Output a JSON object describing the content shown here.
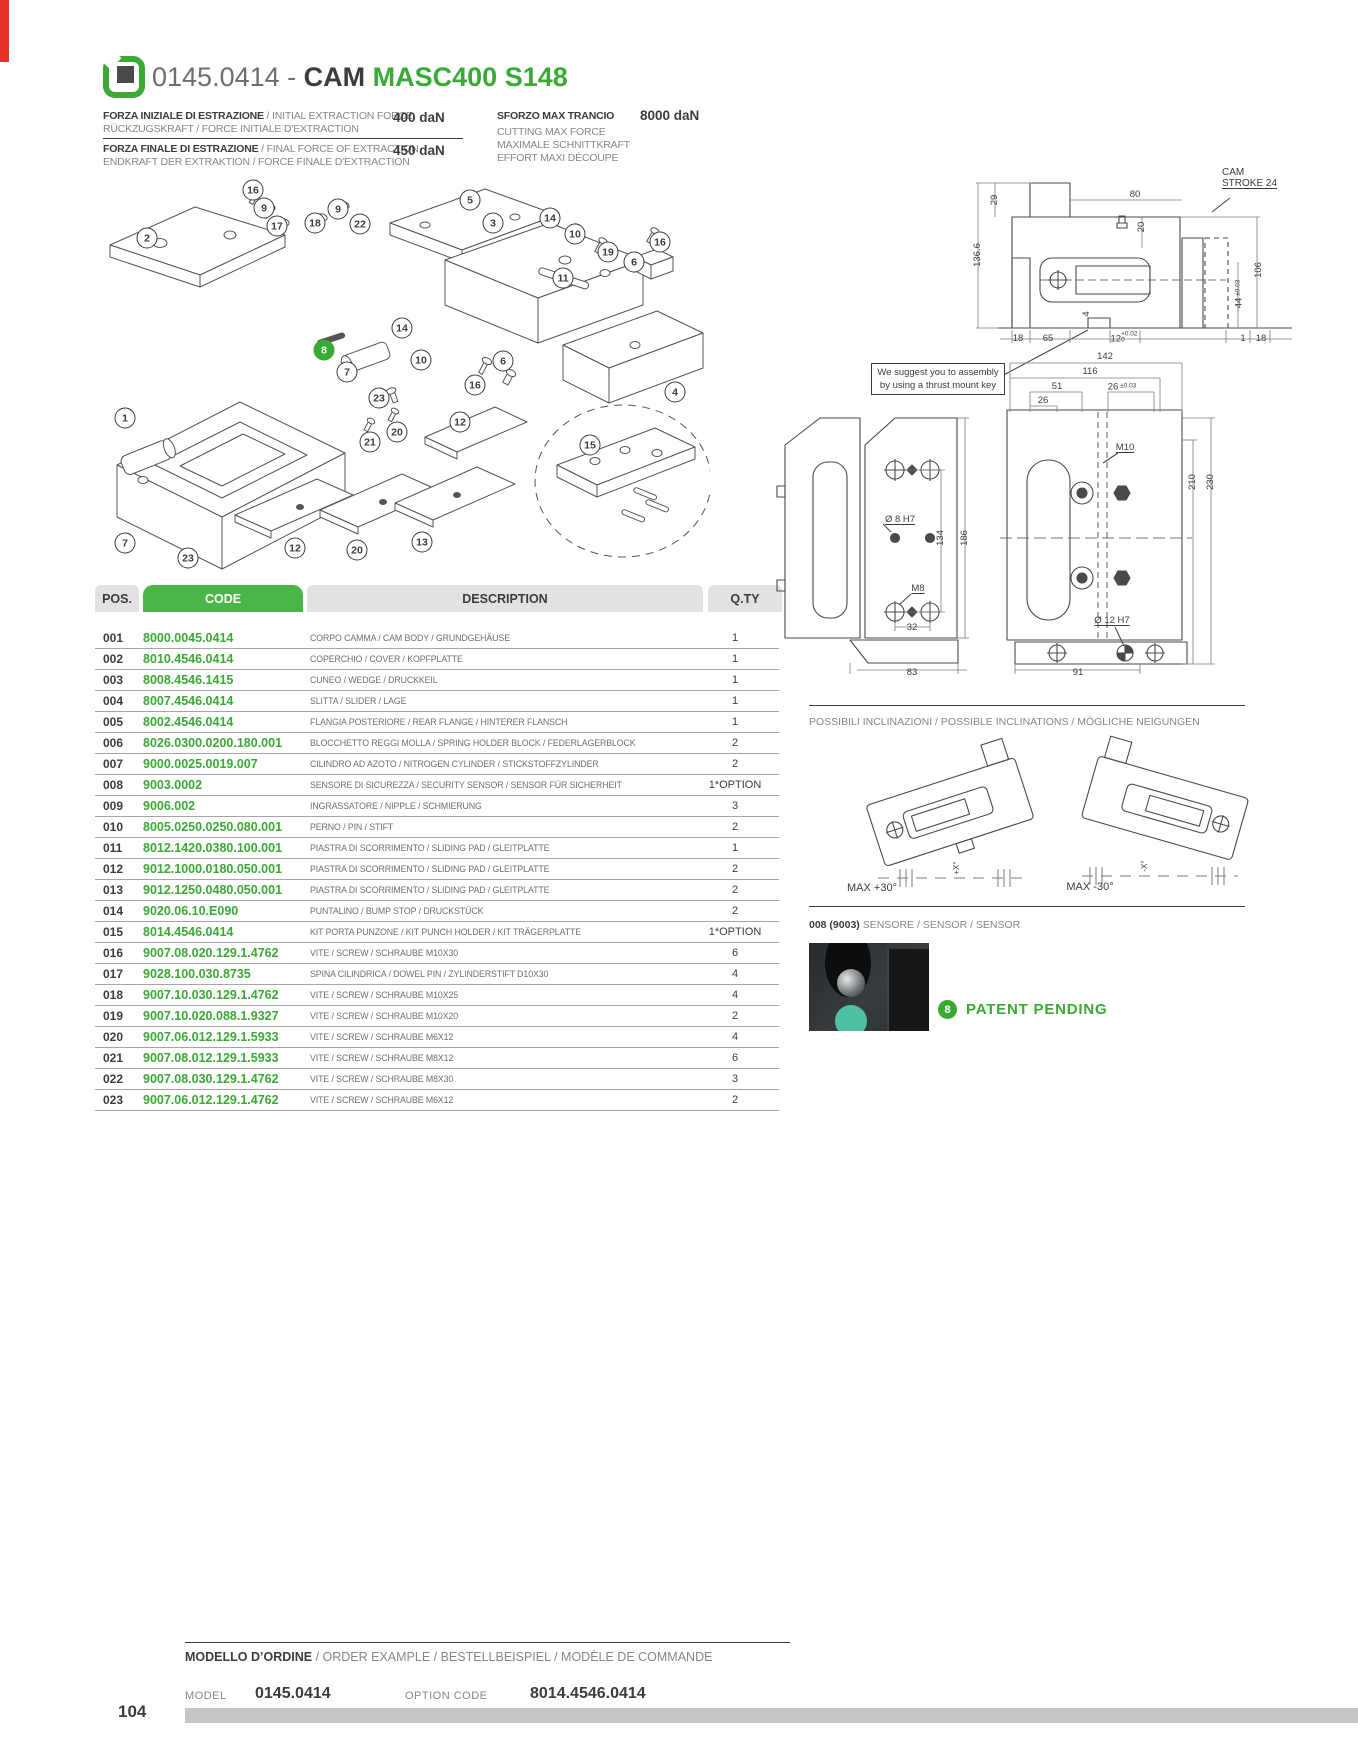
{
  "page": {
    "number": "104"
  },
  "colors": {
    "green": "#3aaa35",
    "green_header": "#4bb648",
    "dark": "#3c3c3b",
    "gray": "#878786",
    "red": "#e5332a"
  },
  "header": {
    "prefix": "0145.0414",
    "separator": " - ",
    "name": "CAM ",
    "variant": "MASC400 S148",
    "logo_icon": "brand-cam-icon"
  },
  "specs": {
    "rows": [
      {
        "primary": "FORZA INIZIALE DI ESTRAZIONE",
        "secondary": " / INITIAL EXTRACTION FORCE",
        "line2": "RÜCKZUGSKRAFT / FORCE INITIALE D'EXTRACTION",
        "value": "400 daN"
      },
      {
        "primary": "FORZA FINALE DI ESTRAZIONE",
        "secondary": " / FINAL FORCE OF EXTRACTION",
        "line2": "ENDKRAFT DER EXTRAKTION / FORCE FINALE D'EXTRACTION",
        "value": "450 daN"
      }
    ],
    "max_cut": {
      "title": "SFORZO MAX TRANCIO",
      "value": "8000 daN",
      "lines": [
        "CUTTING MAX FORCE",
        "MAXIMALE SCHNITTKRAFT",
        "EFFORT MAXI DÉCOUPE"
      ]
    }
  },
  "exploded": {
    "balloons": [
      {
        "n": "16",
        "x": 253,
        "y": 190
      },
      {
        "n": "9",
        "x": 264,
        "y": 208
      },
      {
        "n": "17",
        "x": 277,
        "y": 226
      },
      {
        "n": "2",
        "x": 147,
        "y": 238
      },
      {
        "n": "18",
        "x": 315,
        "y": 223
      },
      {
        "n": "9",
        "x": 338,
        "y": 209
      },
      {
        "n": "22",
        "x": 360,
        "y": 224
      },
      {
        "n": "5",
        "x": 470,
        "y": 200
      },
      {
        "n": "3",
        "x": 493,
        "y": 223
      },
      {
        "n": "14",
        "x": 550,
        "y": 218
      },
      {
        "n": "10",
        "x": 575,
        "y": 234
      },
      {
        "n": "19",
        "x": 608,
        "y": 252
      },
      {
        "n": "6",
        "x": 634,
        "y": 262
      },
      {
        "n": "16",
        "x": 660,
        "y": 242
      },
      {
        "n": "11",
        "x": 563,
        "y": 278
      },
      {
        "n": "14",
        "x": 402,
        "y": 328
      },
      {
        "n": "10",
        "x": 421,
        "y": 360
      },
      {
        "n": "8",
        "x": 324,
        "y": 350,
        "accent": true
      },
      {
        "n": "7",
        "x": 347,
        "y": 372
      },
      {
        "n": "23",
        "x": 379,
        "y": 398
      },
      {
        "n": "1",
        "x": 125,
        "y": 418
      },
      {
        "n": "21",
        "x": 370,
        "y": 442
      },
      {
        "n": "20",
        "x": 397,
        "y": 432
      },
      {
        "n": "12",
        "x": 460,
        "y": 422
      },
      {
        "n": "6",
        "x": 503,
        "y": 361
      },
      {
        "n": "16",
        "x": 475,
        "y": 385
      },
      {
        "n": "15",
        "x": 590,
        "y": 445
      },
      {
        "n": "4",
        "x": 675,
        "y": 392
      },
      {
        "n": "7",
        "x": 125,
        "y": 543
      },
      {
        "n": "23",
        "x": 188,
        "y": 558
      },
      {
        "n": "12",
        "x": 295,
        "y": 548
      },
      {
        "n": "20",
        "x": 357,
        "y": 550
      },
      {
        "n": "13",
        "x": 422,
        "y": 542
      }
    ]
  },
  "table": {
    "headers": {
      "pos": "POS.",
      "code": "CODE",
      "description": "DESCRIPTION",
      "qty": "Q.TY"
    },
    "rows": [
      {
        "pos": "001",
        "code": "8000.0045.0414",
        "desc": "CORPO CAMMA / CAM BODY / GRUNDGEHÄUSE",
        "qty": "1"
      },
      {
        "pos": "002",
        "code": "8010.4546.0414",
        "desc": "COPERCHIO / COVER / KOPFPLATTE",
        "qty": "1"
      },
      {
        "pos": "003",
        "code": "8008.4546.1415",
        "desc": "CUNEO / WEDGE / DRUCKKEIL",
        "qty": "1"
      },
      {
        "pos": "004",
        "code": "8007.4546.0414",
        "desc": "SLITTA / SLIDER / LAGE",
        "qty": "1"
      },
      {
        "pos": "005",
        "code": "8002.4546.0414",
        "desc": "FLANGIA POSTERIORE / REAR FLANGE / HINTERER FLANSCH",
        "qty": "1"
      },
      {
        "pos": "006",
        "code": "8026.0300.0200.180.001",
        "desc": "BLOCCHETTO REGGI MOLLA / SPRING HOLDER BLOCK / FEDERLAGERBLOCK",
        "qty": "2"
      },
      {
        "pos": "007",
        "code": "9000.0025.0019.007",
        "desc": "CILINDRO AD AZOTO / NITROGEN CYLINDER / STICKSTOFFZYLINDER",
        "qty": "2"
      },
      {
        "pos": "008",
        "code": "9003.0002",
        "desc": "SENSORE DI SICUREZZA / SECURITY SENSOR / SENSOR FÜR SICHERHEIT",
        "qty": "1*OPTION"
      },
      {
        "pos": "009",
        "code": "9006.002",
        "desc": "INGRASSATORE / NIPPLE / SCHMIERUNG",
        "qty": "3"
      },
      {
        "pos": "010",
        "code": "8005.0250.0250.080.001",
        "desc": "PERNO / PIN / STIFT",
        "qty": "2"
      },
      {
        "pos": "011",
        "code": "8012.1420.0380.100.001",
        "desc": "PIASTRA DI SCORRIMENTO / SLIDING PAD / GLEITPLATTE",
        "qty": "1"
      },
      {
        "pos": "012",
        "code": "9012.1000.0180.050.001",
        "desc": "PIASTRA DI SCORRIMENTO / SLIDING PAD / GLEITPLATTE",
        "qty": "2"
      },
      {
        "pos": "013",
        "code": "9012.1250.0480.050.001",
        "desc": "PIASTRA DI SCORRIMENTO / SLIDING PAD / GLEITPLATTE",
        "qty": "2"
      },
      {
        "pos": "014",
        "code": "9020.06.10.E090",
        "desc": "PUNTALINO / BUMP STOP / DRUCKSTÜCK",
        "qty": "2"
      },
      {
        "pos": "015",
        "code": "8014.4546.0414",
        "desc": "KIT PORTA PUNZONE / KIT PUNCH HOLDER / KIT TRÄGERPLATTE",
        "qty": "1*OPTION"
      },
      {
        "pos": "016",
        "code": "9007.08.020.129.1.4762",
        "desc": "VITE / SCREW / SCHRAUBE M10X30",
        "qty": "6"
      },
      {
        "pos": "017",
        "code": "9028.100.030.8735",
        "desc": "SPINA CILINDRICA / DOWEL PIN / ZYLINDERSTIFT D10X30",
        "qty": "4"
      },
      {
        "pos": "018",
        "code": "9007.10.030.129.1.4762",
        "desc": "VITE / SCREW / SCHRAUBE M10X25",
        "qty": "4"
      },
      {
        "pos": "019",
        "code": "9007.10.020.088.1.9327",
        "desc": "VITE / SCREW / SCHRAUBE M10X20",
        "qty": "2"
      },
      {
        "pos": "020",
        "code": "9007.06.012.129.1.5933",
        "desc": "VITE / SCREW / SCHRAUBE M6X12",
        "qty": "4"
      },
      {
        "pos": "021",
        "code": "9007.08.012.129.1.5933",
        "desc": "VITE / SCREW / SCHRAUBE M8X12",
        "qty": "6"
      },
      {
        "pos": "022",
        "code": "9007.08.030.129.1.4762",
        "desc": "VITE / SCREW / SCHRAUBE M8X30",
        "qty": "3"
      },
      {
        "pos": "023",
        "code": "9007.06.012.129.1.4762",
        "desc": "VITE / SCREW / SCHRAUBE M6X12",
        "qty": "2"
      }
    ]
  },
  "drawings": {
    "note_line1": "We suggest you to assembly",
    "note_line2": "by using a thrust mount key",
    "cam_stroke_1": "CAM",
    "cam_stroke_2": "STROKE 24",
    "annotations": [
      {
        "t": "29",
        "x": 995,
        "y": 200,
        "rot": true
      },
      {
        "t": "136.6",
        "x": 978,
        "y": 255,
        "rot": true
      },
      {
        "t": "80",
        "x": 1135,
        "y": 195
      },
      {
        "t": "20",
        "x": 1142,
        "y": 227,
        "rot": true
      },
      {
        "t": "106",
        "x": 1259,
        "y": 270,
        "rot": true
      },
      {
        "t": "44",
        "tol": "±0.03",
        "x": 1239,
        "y": 294,
        "rot": true
      },
      {
        "t": "4",
        "x": 1087,
        "y": 314,
        "rot": true
      },
      {
        "t": "18",
        "x": 1018,
        "y": 339
      },
      {
        "t": "65",
        "x": 1048,
        "y": 339
      },
      {
        "t": "12",
        "tol2": "+0.02|0",
        "x": 1124,
        "y": 338
      },
      {
        "t": "1",
        "x": 1243,
        "y": 339
      },
      {
        "t": "18",
        "x": 1261,
        "y": 339
      },
      {
        "t": "142",
        "x": 1105,
        "y": 357
      },
      {
        "t": "116",
        "x": 1090,
        "y": 372
      },
      {
        "t": "51",
        "x": 1057,
        "y": 387
      },
      {
        "t": "26",
        "tol": "±0.03",
        "x": 1122,
        "y": 387
      },
      {
        "t": "26",
        "x": 1043,
        "y": 401
      },
      {
        "t": "M10",
        "x": 1125,
        "y": 448,
        "u": true
      },
      {
        "t": "Ø 8  H7",
        "x": 900,
        "y": 520,
        "u": true
      },
      {
        "t": "134",
        "x": 941,
        "y": 538,
        "rot": true
      },
      {
        "t": "186",
        "x": 965,
        "y": 538,
        "rot": true
      },
      {
        "t": "M8",
        "x": 918,
        "y": 589,
        "u": true
      },
      {
        "t": "32",
        "x": 912,
        "y": 628
      },
      {
        "t": "83",
        "x": 912,
        "y": 673
      },
      {
        "t": "91",
        "x": 1078,
        "y": 673
      },
      {
        "t": "Ø 12  H7",
        "x": 1112,
        "y": 621,
        "u": true
      },
      {
        "t": "210",
        "x": 1193,
        "y": 482,
        "rot": true
      },
      {
        "t": "230",
        "x": 1211,
        "y": 482,
        "rot": true
      },
      {
        "t": "MAX +30°",
        "x": 872,
        "y": 888,
        "cls": "incl"
      },
      {
        "t": "MAX -30°",
        "x": 1090,
        "y": 887,
        "cls": "incl"
      },
      {
        "t": "+X°",
        "x": 957,
        "y": 868,
        "rot": true,
        "cls": "tiny"
      },
      {
        "t": "-X°",
        "x": 1145,
        "y": 866,
        "rot": true,
        "cls": "tiny"
      }
    ]
  },
  "inclinations": {
    "title": "POSSIBILI INCLINAZIONI / POSSIBLE INCLINATIONS / MÖGLICHE NEIGUNGEN"
  },
  "sensor": {
    "ref": "008 (9003)",
    "label": " SENSORE / SENSOR / SENSOR"
  },
  "patent": {
    "badge": "8",
    "text": "PATENT PENDING"
  },
  "footer": {
    "title_primary": "MODELLO D’ORDINE",
    "title_secondary": " / ORDER EXAMPLE / BESTELLBEISPIEL / MODÈLE DE COMMANDE",
    "model_label": "MODEL",
    "model_value": "0145.0414",
    "option_label": "OPTION CODE",
    "option_value": "8014.4546.0414"
  }
}
